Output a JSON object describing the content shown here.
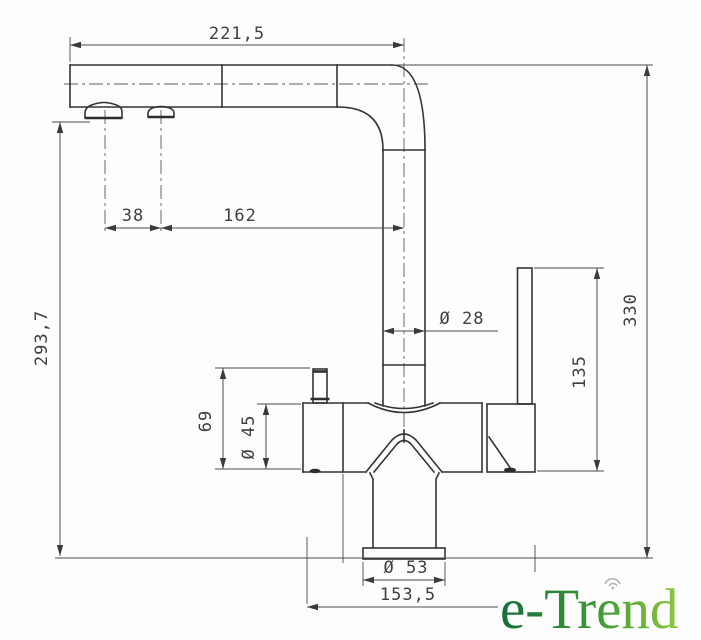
{
  "drawing": {
    "title": "kitchen faucet technical drawing - side elevation with dimensions",
    "dimensions": {
      "spout_reach": "221,5",
      "aerator_spacing": "38",
      "aerator_to_axis": "162",
      "spout_height": "293,7",
      "pipe_diameter": "Ø 28",
      "overall_height": "330",
      "lever_height": "135",
      "body_height": "69",
      "body_diameter": "Ø 45",
      "base_diameter": "Ø 53",
      "overall_depth": "153,5"
    },
    "logo": {
      "text": "e-Trend",
      "color_start": "#156f38",
      "color_end": "#8cc63f"
    }
  }
}
